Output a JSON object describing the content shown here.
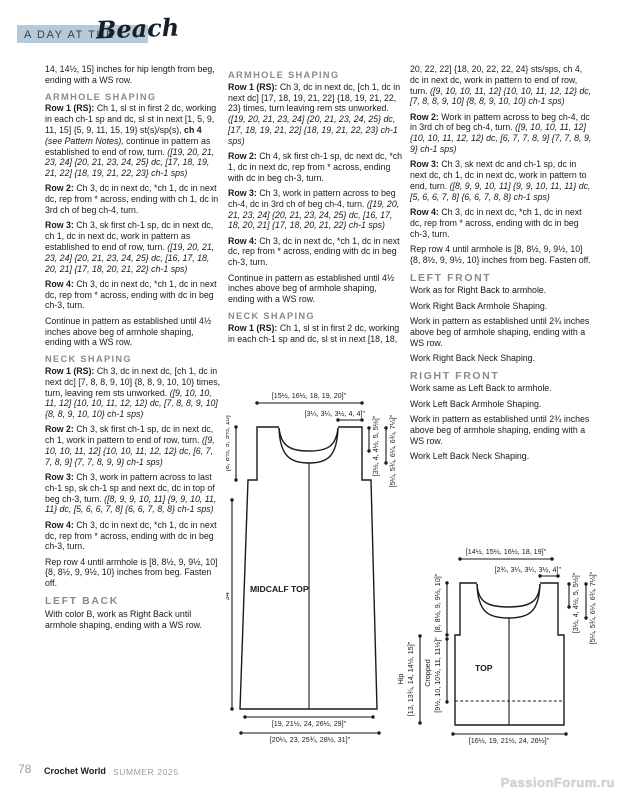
{
  "header": {
    "prefix": "A DAY AT THE",
    "script": "Beach",
    "bar_color": "#b6c9d9"
  },
  "columns": {
    "col1": [
      {
        "k": "p",
        "r": [
          [
            "",
            "14, 14½, 15] inches for hip length from beg, ending with a WS row."
          ]
        ]
      },
      {
        "k": "h2",
        "r": [
          [
            "",
            "ARMHOLE SHAPING"
          ]
        ]
      },
      {
        "k": "p",
        "r": [
          [
            "b",
            "Row 1 (RS): "
          ],
          [
            "",
            "Ch 1, sl st in first 2 dc, working in each ch-1 sp and dc, sl st in next [1, 5, 9, 11, 15] {5, 9, 11, 15, 19} st(s)/sp(s), "
          ],
          [
            "b",
            "ch 4 "
          ],
          [
            "i",
            "(see Pattern Notes),"
          ],
          [
            "",
            "  continue in pattern as established to end of row, turn. "
          ],
          [
            "i",
            "([19, 20, 21, 23, 24] {20, 21, 23, 24, 25} dc, [17, 18, 19, 21, 22] {18, 19, 21, 22, 23} ch-1 sps)"
          ]
        ]
      },
      {
        "k": "p",
        "r": [
          [
            "b",
            "Row 2: "
          ],
          [
            "",
            "Ch 3, dc in next dc, *ch 1, dc in next dc, rep from * across, ending with ch 1, dc in 3rd ch of beg ch-4, turn."
          ]
        ]
      },
      {
        "k": "p",
        "r": [
          [
            "b",
            "Row 3: "
          ],
          [
            "",
            "Ch 3, sk first ch-1 sp, dc in next dc, ch 1, dc in next dc, work in pattern as established to end of row, turn. "
          ],
          [
            "i",
            "([19, 20, 21, 23, 24] {20, 21, 23, 24, 25} dc, [16, 17, 18, 20, 21] {17, 18, 20, 21, 22} ch-1 sps)"
          ]
        ]
      },
      {
        "k": "p",
        "r": [
          [
            "b",
            "Row 4: "
          ],
          [
            "",
            "Ch 3, dc in next dc, *ch 1, dc in next dc, rep from * across, ending with dc in beg ch-3, turn."
          ]
        ]
      },
      {
        "k": "p",
        "r": [
          [
            "",
            "Continue in pattern as established until 4½ inches above beg of armhole shaping, ending with a WS row."
          ]
        ]
      },
      {
        "k": "h2",
        "r": [
          [
            "",
            "NECK SHAPING"
          ]
        ]
      },
      {
        "k": "p",
        "r": [
          [
            "b",
            "Row 1 (RS): "
          ],
          [
            "",
            "Ch 3, dc in next dc, [ch 1, dc in next dc] [7, 8, 8, 9, 10] {8, 8, 9, 10, 10} times, turn, leaving rem sts unworked. "
          ],
          [
            "i",
            "([9, 10, 10, 11, 12] {10, 10, 11, 12, 12} dc, [7, 8, 8, 9, 10] {8, 8, 9, 10, 10} ch-1 sps)"
          ]
        ]
      },
      {
        "k": "p",
        "r": [
          [
            "b",
            "Row 2: "
          ],
          [
            "",
            "Ch 3, sk first ch-1 sp, dc in next dc, ch 1, work in pattern to end of row, turn. "
          ],
          [
            "i",
            "([9, 10, 10, 11, 12] {10, 10, 11, 12, 12} dc, [6, 7, 7, 8, 9] {7, 7, 8, 9, 9} ch-1 sps)"
          ]
        ]
      },
      {
        "k": "p",
        "r": [
          [
            "b",
            "Row 3: "
          ],
          [
            "",
            "Ch 3, work in pattern across to last ch-1 sp, sk ch-1 sp and next dc, dc in top of beg ch-3, turn. "
          ],
          [
            "i",
            "([8, 9, 9, 10, 11] {9, 9, 10, 11, 11} dc, [5, 6, 6, 7, 8] {6, 6, 7, 8, 8} ch-1 sps)"
          ]
        ]
      },
      {
        "k": "p",
        "r": [
          [
            "b",
            "Row 4: "
          ],
          [
            "",
            "Ch 3, dc in next dc, *ch 1, dc in next dc, rep from * across, ending with dc in beg ch-3, turn."
          ]
        ]
      },
      {
        "k": "p",
        "r": [
          [
            "",
            "Rep row 4 until armhole is [8, 8½, 9, 9½, 10] {8, 8½, 9, 9½, 10} inches from beg. Fasten off."
          ]
        ]
      },
      {
        "k": "h1",
        "r": [
          [
            "",
            "LEFT BACK"
          ]
        ]
      },
      {
        "k": "p",
        "r": [
          [
            "",
            "With color B, work as Right Back until armhole shaping, ending with a WS row."
          ]
        ]
      }
    ],
    "col2": [
      {
        "k": "h2",
        "r": [
          [
            "",
            "ARMHOLE SHAPING"
          ]
        ]
      },
      {
        "k": "p",
        "r": [
          [
            "b",
            "Row 1 (RS): "
          ],
          [
            "",
            "Ch 3, dc in next dc, [ch 1, dc in next dc] [17, 18, 19, 21, 22] {18, 19, 21, 22, 23} times, turn leaving rem sts unworked. "
          ],
          [
            "i",
            "([19, 20, 21, 23, 24] {20, 21, 23, 24, 25} dc, [17, 18, 19, 21, 22] {18, 19, 21, 22, 23} ch-1 sps)"
          ]
        ]
      },
      {
        "k": "p",
        "r": [
          [
            "b",
            "Row 2: "
          ],
          [
            "",
            "Ch 4, sk first ch-1 sp, dc next dc, *ch 1, dc in next dc, rep from * across, ending with dc in beg ch-3, turn."
          ]
        ]
      },
      {
        "k": "p",
        "r": [
          [
            "b",
            "Row 3: "
          ],
          [
            "",
            "Ch 3, work in pattern across to beg ch-4, dc in 3rd ch of beg ch-4, turn. "
          ],
          [
            "i",
            "([19, 20, 21, 23, 24] {20, 21, 23, 24, 25} dc, [16, 17, 18, 20, 21] {17, 18, 20, 21, 22} ch-1 sps)"
          ]
        ]
      },
      {
        "k": "p",
        "r": [
          [
            "b",
            "Row 4: "
          ],
          [
            "",
            "Ch 3, dc in next dc, *ch 1, dc in next dc, rep from * across, ending with dc in beg ch-3, turn."
          ]
        ]
      },
      {
        "k": "p",
        "r": [
          [
            "",
            "Continue in pattern as established until 4½ inches above beg of armhole shaping, ending with a WS row."
          ]
        ]
      },
      {
        "k": "h2",
        "r": [
          [
            "",
            "NECK SHAPING"
          ]
        ]
      },
      {
        "k": "p",
        "r": [
          [
            "b",
            "Row 1 (RS): "
          ],
          [
            "",
            "Ch 1, sl st in first 2 dc, working in each ch-1 sp and dc, sl st in next [18, 18,"
          ]
        ]
      }
    ],
    "col3": [
      {
        "k": "p",
        "r": [
          [
            "",
            "20, 22, 22] {18, 20, 22, 22, 24} sts/sps, ch 4, dc in next dc, work in pattern to end of row, turn. "
          ],
          [
            "i",
            "([9, 10, 10, 11, 12] {10, 10, 11, 12, 12} dc, [7, 8, 8, 9, 10] {8, 8, 9, 10, 10} ch-1 sps)"
          ]
        ]
      },
      {
        "k": "p",
        "r": [
          [
            "b",
            "Row 2: "
          ],
          [
            "",
            "Work in pattern across to beg ch-4, dc in 3rd ch of beg ch-4, turn. "
          ],
          [
            "i",
            "([9, 10, 10, 11, 12] {10, 10, 11, 12, 12} dc, [6, 7, 7, 8, 9] {7, 7, 8, 9, 9} ch-1 sps)"
          ]
        ]
      },
      {
        "k": "p",
        "r": [
          [
            "b",
            "Row 3: "
          ],
          [
            "",
            "Ch 3, sk next dc and ch-1 sp, dc in next dc, ch 1, dc in next dc, work in pattern to end, turn. "
          ],
          [
            "i",
            "([8, 9, 9, 10, 11] {9, 9, 10, 11, 11} dc, [5, 6, 6, 7, 8] {6, 6, 7, 8, 8} ch-1 sps)"
          ]
        ]
      },
      {
        "k": "p",
        "r": [
          [
            "b",
            "Row 4: "
          ],
          [
            "",
            "Ch 3, dc in next dc, *ch 1, dc in next dc, rep from * across, ending with dc in beg ch-3, turn."
          ]
        ]
      },
      {
        "k": "p",
        "r": [
          [
            "",
            "Rep row 4 until armhole is [8, 8½, 9, 9½, 10] {8, 8½, 9, 9½, 10} inches from beg. Fasten off."
          ]
        ]
      },
      {
        "k": "h1",
        "r": [
          [
            "",
            "LEFT FRONT"
          ]
        ]
      },
      {
        "k": "p",
        "r": [
          [
            "",
            "Work as for Right Back to armhole."
          ]
        ]
      },
      {
        "k": "p",
        "r": [
          [
            "",
            "Work Right Back Armhole Shaping."
          ]
        ]
      },
      {
        "k": "p",
        "r": [
          [
            "",
            "Work in pattern as established until 2¾ inches above beg of armhole shaping, ending with a WS row."
          ]
        ]
      },
      {
        "k": "p",
        "r": [
          [
            "",
            "Work Right Back Neck Shaping."
          ]
        ]
      },
      {
        "k": "h1",
        "r": [
          [
            "",
            "RIGHT FRONT"
          ]
        ]
      },
      {
        "k": "p",
        "r": [
          [
            "",
            "Work same as Left Back to armhole."
          ]
        ]
      },
      {
        "k": "p",
        "r": [
          [
            "",
            "Work Left Back Armhole Shaping."
          ]
        ]
      },
      {
        "k": "p",
        "r": [
          [
            "",
            "Work in pattern as established until 2¾ inches above beg of armhole shaping, ending with a WS row."
          ]
        ]
      },
      {
        "k": "p",
        "r": [
          [
            "",
            "Work Left Back Neck Shaping."
          ]
        ]
      }
    ]
  },
  "diagram1": {
    "name": "MIDCALF TOP",
    "top_width": "[15½, 16½, 18, 19, 20]\"",
    "neck_width": "[3¼, 3¼, 3½, 4, 4]\"",
    "back_neck_depth": "[3½, 4, 4½, 5, 5½]\"",
    "front_neck_depth": "[5¼, 5¾, 6¼, 6¾, 7¼]\"",
    "armhole_depth": "[8, 8½, 9, 9½, 10]\"",
    "total_length": "34\"",
    "hem_width_upper": "[19, 21½, 24, 26½, 29]\"",
    "hem_width_lower": "[20¼, 23, 25¾, 28½, 31]\""
  },
  "diagram2": {
    "name": "TOP",
    "top_width": "[14½, 15½, 16½, 18, 19]\"",
    "neck_width": "[2¾, 3¼, 3¼, 3½, 4]\"",
    "back_neck_depth": "[3½, 4, 4½, 5, 5½]\"",
    "front_neck_depth": "[5¼, 5¾, 6¼, 6¾, 7¼]\"",
    "armhole_depth": "[8, 8½, 9, 9½, 10]\"",
    "cropped_label": "Cropped",
    "cropped_length": "[9½, 10, 10½, 11, 11½]\"",
    "hip_label": "Hip",
    "hip_length": "[13, 13¾, 14, 14½, 15]\"",
    "hem_width": "[16½, 19, 21½, 24, 26½]\""
  },
  "footer": {
    "page_number": "78",
    "magazine": "Crochet World",
    "issue": "SUMMER 2025",
    "watermark": "PassionForum.ru"
  }
}
